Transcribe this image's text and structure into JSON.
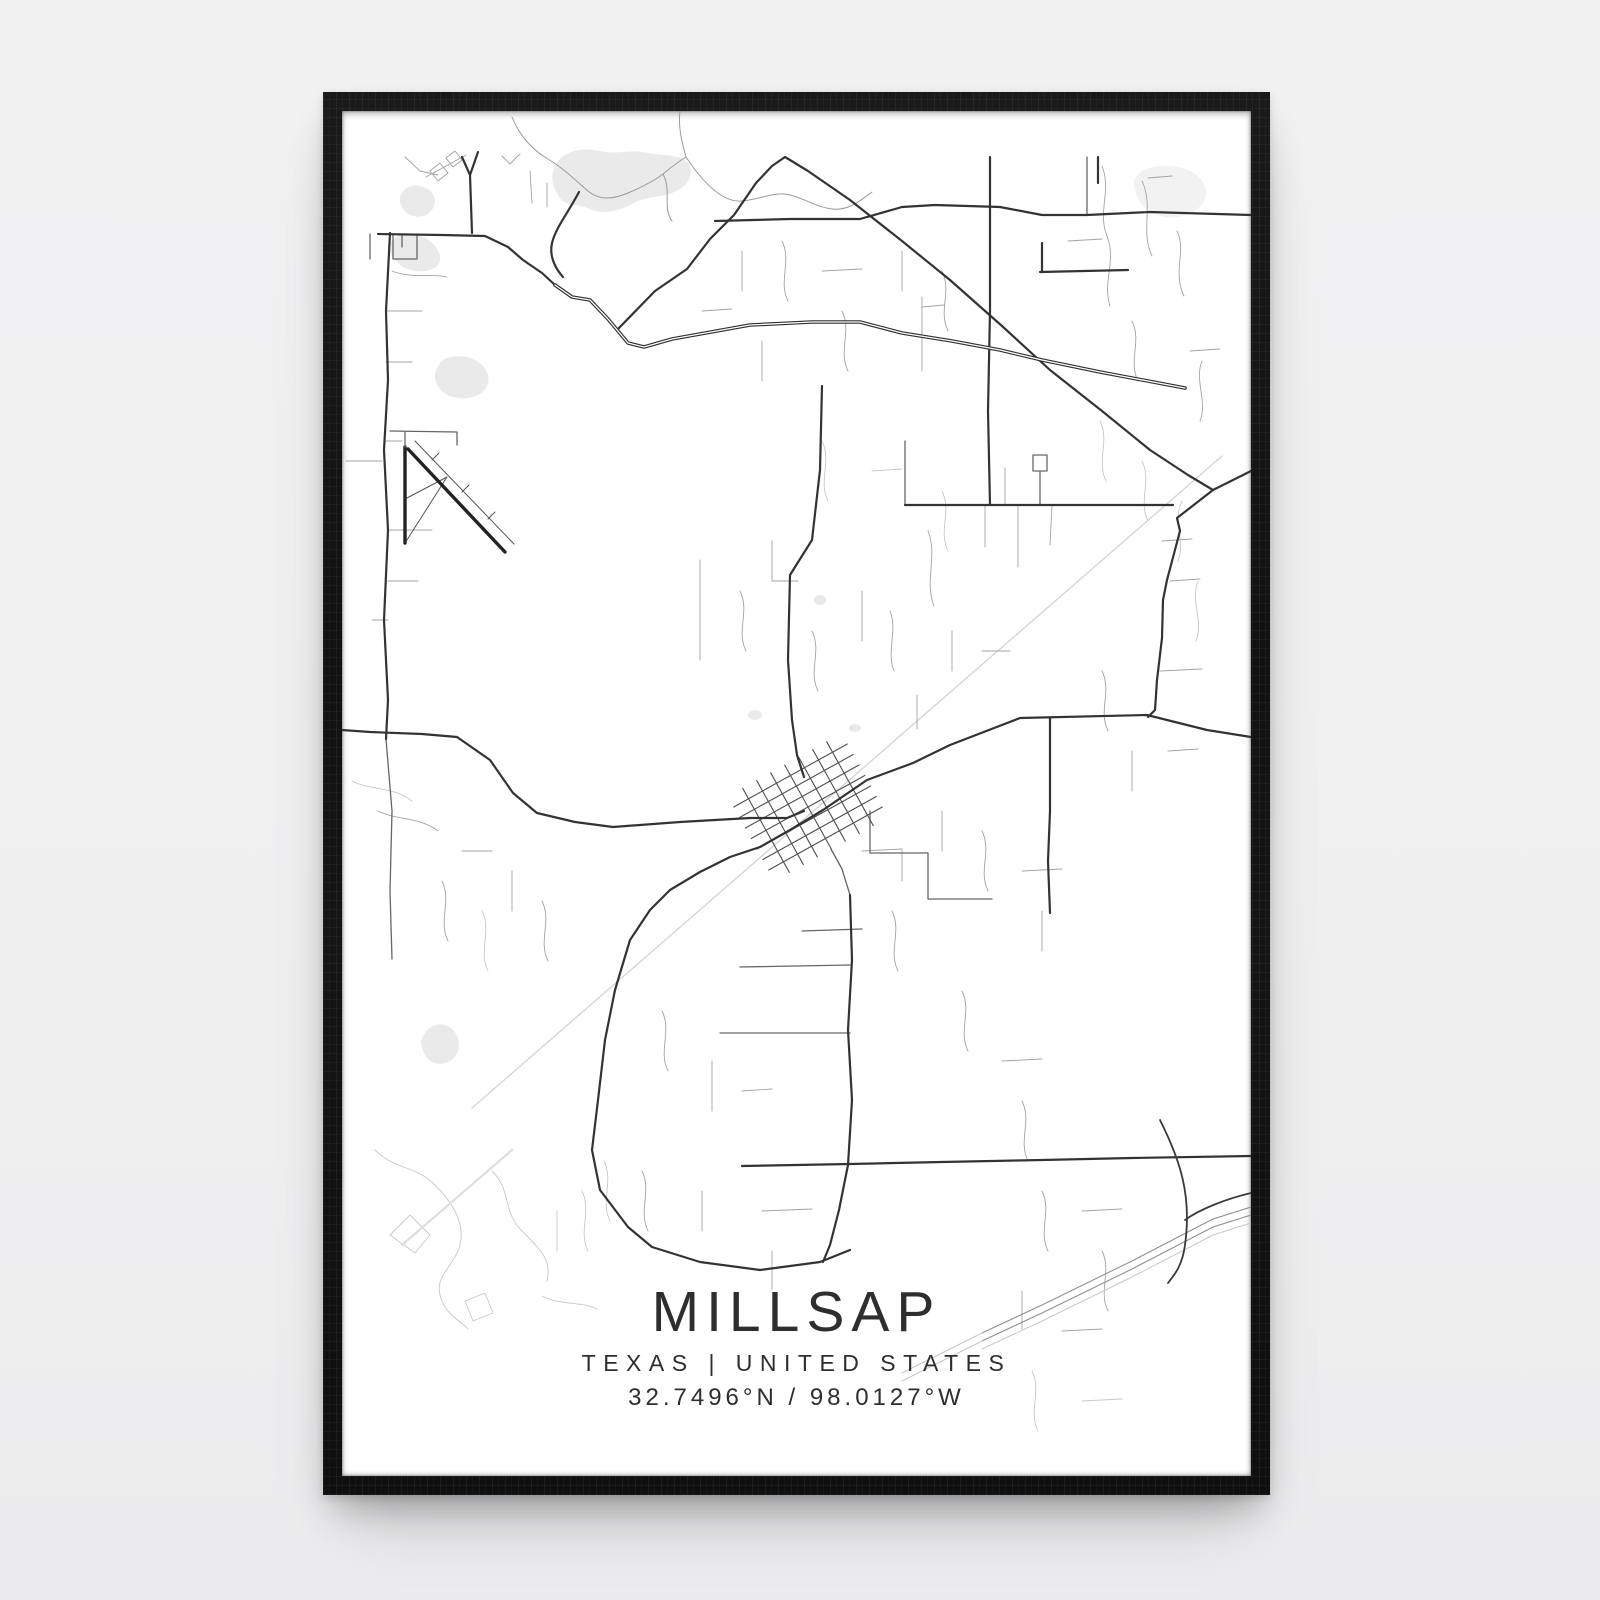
{
  "poster": {
    "title": "MILLSAP",
    "subtitle": "TEXAS | UNITED STATES",
    "coordinates": "32.7496°N / 98.0127°W"
  },
  "colors": {
    "page_background": "#f0f0f1",
    "frame": "#141414",
    "print": "#ffffff",
    "water": "#eaeaea",
    "text_primary": "#262626",
    "text_secondary": "#3a3a3a",
    "text_coords": "#474747"
  },
  "map": {
    "viewbox": "0 0 909 1365",
    "styles": {
      "major": {
        "c": "#333333",
        "w": 2.2
      },
      "major2": {
        "c": "#3a3a3a",
        "w": 1.8
      },
      "casing": {
        "c": "#2f2f2f",
        "w": 3.6
      },
      "core": {
        "c": "#ffffff",
        "w": 1.3
      },
      "medium": {
        "c": "#666666",
        "w": 1.3
      },
      "minor": {
        "c": "#a3a3a3",
        "w": 0.9
      },
      "river": {
        "c": "#9b9b9b",
        "w": 1.0
      },
      "faint": {
        "c": "#c8c8c8",
        "w": 0.9
      },
      "railband": {
        "c": "#dedede",
        "w": 2.2
      },
      "rail": {
        "c": "#d6d6d6",
        "w": 1.4
      },
      "grid": {
        "c": "#4f4f4f",
        "w": 1.1
      },
      "runway": {
        "c": "#222222",
        "w": 3.4
      },
      "apron": {
        "c": "#555555",
        "w": 1.0
      },
      "hwy": {
        "c": "#8f8f8f",
        "w": 1.1
      },
      "hwyfade": {
        "c": "#c9c9c9",
        "w": 1.0
      }
    },
    "water": [
      {
        "n": "lake-top-center",
        "d": "M213,55 C220,40 240,36 258,40 C276,44 288,38 306,42 C324,46 338,42 346,52 C352,60 348,72 338,78 C322,88 306,84 292,92 C278,100 262,104 248,98 C234,92 222,96 216,84 C210,74 208,66 213,55 Z"
      },
      {
        "n": "pond-left-upper",
        "d": "M63,78 C70,72 84,74 90,82 C96,90 92,100 84,104 C74,108 64,104 60,96 C56,88 58,84 63,78 Z"
      },
      {
        "n": "pond-left",
        "d": "M51,128 C60,120 78,122 88,130 C98,138 102,150 94,156 C84,163 64,161 56,152 C48,144 44,136 51,128 Z"
      },
      {
        "n": "pond-left-mid",
        "d": "M100,250 C110,242 130,244 140,254 C150,264 148,278 136,284 C124,290 106,288 98,278 C90,268 92,258 100,250 Z"
      },
      {
        "n": "pond-bottom-left",
        "d": "M83,922 C90,912 104,910 112,920 C120,930 118,944 108,950 C98,956 86,952 82,942 C78,932 78,930 83,922 Z"
      },
      {
        "n": "patch-top-right",
        "d": "M800,60 C820,50 850,55 860,70 C870,85 860,100 840,105 C820,110 800,100 795,85 C790,70 790,68 800,60 Z",
        "fill": "#f2f2f2"
      }
    ],
    "ponds": [
      {
        "cx": 413,
        "cy": 604,
        "rx": 7,
        "ry": 5
      },
      {
        "cx": 513,
        "cy": 617,
        "rx": 6,
        "ry": 4
      },
      {
        "cx": 478,
        "cy": 489,
        "rx": 6,
        "ry": 5
      }
    ],
    "roads": [
      {
        "s": "faint",
        "n": "tracks-bottom-left",
        "d": "M33,1039 C53,1059 73,1054 93,1074 C113,1094 123,1114 118,1134 C113,1154 93,1164 98,1184 C103,1204 118,1209 126,1218 M48,1124 L68,1104 L88,1124 L73,1142 Z M123,1190 L143,1182 L151,1202 L131,1210 Z M150,1060 C170,1080 160,1100 180,1120 C200,1140 210,1150 205,1170 M215,1100 L215,1140 M240,1080 C250,1100 236,1120 246,1140 M262,1050 C272,1070 258,1090 268,1110 M200,1185 C220,1195 240,1190 255,1198"
      },
      {
        "s": "railband",
        "n": "rail-spur-fading",
        "d": "M170,1039 L60,1134"
      },
      {
        "s": "faint",
        "n": "tracks-top-right",
        "d": "M758,310 C768,330 754,350 764,370 M800,350 C810,370 796,390 806,410 M840,390 C830,410 844,430 836,450 M856,470 C848,490 862,510 854,530"
      },
      {
        "s": "faint",
        "n": "tracks-middle",
        "d": "M480,330 C490,350 476,370 486,390 M530,360 L560,358 M600,380 C610,400 596,420 606,440 M10,670 C30,680 50,675 70,690 M140,800 C150,820 136,840 146,860 M690,1260 C700,1280 686,1300 696,1320 M740,1290 L780,1288"
      },
      {
        "s": "rail",
        "n": "railroad-diagonal",
        "d": "M880,345 L130,997"
      },
      {
        "s": "river",
        "n": "river-top",
        "d": "M338,0 C336,16 340,32 344,46 M170,6 C178,26 192,40 206,48 C224,59 234,70 246,80 C258,90 272,88 286,82 C300,76 312,70 321,63 C331,55 337,50 344,46 M344,46 C360,70 380,92 400,90 C420,88 432,80 448,84 C464,88 474,96 490,98 C506,100 518,90 530,81 M321,63 C330,80 320,96 330,110"
      },
      {
        "s": "minor",
        "n": "lanes-top-left",
        "d": "M63,46 L78,60 L96,64 M160,45 L168,53 L178,43 M188,60 L190,92 M205,72 L205,96 M84,66 L124,44"
      },
      {
        "s": "minor",
        "n": "buildings-top-left",
        "d": "M88,60 l10,-8 l8,10 l-10,8 Z M104,47 l9,-7 l7,9 l-9,7 Z"
      },
      {
        "s": "minor",
        "n": "lanes-top-center",
        "d": "M400,140 L400,180 M440,130 C450,150 436,170 446,190 M480,160 L520,158 M500,200 C510,220 496,240 506,260 M560,140 L560,180 M600,160 C610,180 596,200 606,220 M360,200 L390,198 M420,230 L420,270"
      },
      {
        "s": "minor",
        "n": "lanes-top-right",
        "d": "M760,55 C770,80 755,100 765,125 C775,150 760,170 768,195 M800,70 C812,95 798,120 810,145 M835,120 C845,140 830,160 842,185 M790,210 C800,230 786,250 796,270 M860,250 C852,270 866,290 858,310 M726,130 L760,128 M806,67 L830,65 M848,240 L878,238"
      },
      {
        "s": "minor",
        "n": "lanes-middle",
        "d": "M358,449 L358,549 M398,480 C408,500 394,520 404,540 M430,430 L430,470 L456,470 M470,520 C480,540 466,560 476,580 M520,480 L520,530 M548,500 C556,520 544,540 552,560 M586,420 C596,445 582,470 592,495 M610,520 L610,560 M640,540 L668,540 M575,584 L575,618"
      },
      {
        "s": "minor",
        "n": "lanes-left-mid",
        "d": "M50,160 C70,168 90,162 105,166 M46,419 L90,419 M46,470 L76,470 M30,509 L46,509 M4,350 L40,350 M44,330 L60,330 M44,200 L80,200 M44,251 L70,251"
      },
      {
        "s": "minor",
        "n": "lanes-left-bottom",
        "d": "M36,700 C56,710 76,705 96,720 M120,740 L150,740 M100,770 C110,790 96,810 106,830 M170,760 L170,800 M200,790 C210,810 196,830 206,850"
      },
      {
        "s": "minor",
        "n": "lanes-town-east",
        "d": "M520,740 L560,738 L560,770 M550,800 C560,820 546,840 556,860 M600,700 L600,740 M640,720 C650,740 636,760 646,780 M680,760 L720,758 M700,800 L700,840 M620,880 C630,900 616,920 626,940 M660,950 L700,948 M680,990 C690,1010 676,1030 686,1050"
      },
      {
        "s": "minor",
        "n": "lanes-bottom-center",
        "d": "M320,900 C330,920 316,940 326,960 M370,950 L370,1000 M400,980 L430,978 M360,1080 L360,1120 M300,1060 C310,1080 296,1100 306,1120 M420,1100 L470,1098 M430,1140 L430,1178"
      },
      {
        "s": "minor",
        "n": "lanes-bottom-right",
        "d": "M700,1080 C710,1100 696,1120 706,1140 M740,1100 L780,1098 M760,1140 C770,1160 756,1180 766,1200 M680,1180 L680,1218 M720,1220 L760,1218"
      },
      {
        "s": "minor",
        "n": "hangers-right-mid",
        "d": "M643,394 L643,436 M676,394 L676,456 M710,394 L708,434 M663,357 L663,394 M698,362 L698,394 M580,186 L580,260 M580,196 L602,194"
      },
      {
        "s": "minor",
        "n": "stubs-right-column",
        "d": "M820,430 L850,428 M828,470 L858,468 M818,560 L860,558 M826,640 L856,638 M760,560 C770,580 756,600 766,620 M790,640 L790,680"
      },
      {
        "s": "medium",
        "n": "rooms-left-edge",
        "d": "M28,123 L28,148 M51,124 L51,148 L75,148 L75,124 M60,124 L60,136"
      },
      {
        "s": "medium",
        "n": "stubs-near-south-road",
        "d": "M398,856 L508,854 M378,922 L508,922 M460,820 L520,818"
      },
      {
        "s": "medium",
        "n": "block-roads-southeast",
        "d": "M528,700 L528,742 L586,742 L586,788 L650,788"
      },
      {
        "s": "medium",
        "n": "hanger-up-right-mid",
        "d": "M563,394 L563,330"
      },
      {
        "s": "medium",
        "n": "loop-square-right",
        "d": "M691,344 L705,344 L705,360 L691,360 Z M698,360 L698,394"
      },
      {
        "s": "medium",
        "n": "vertical-top-right",
        "d": "M745,46 L745,104"
      },
      {
        "s": "medium",
        "n": "grid-exit-southeast",
        "d": "M489,738 L500,758 L508,784"
      },
      {
        "s": "medium",
        "n": "left-vertical-lower",
        "d": "M44,628 L50,700 L48,780 L50,848"
      },
      {
        "s": "grid",
        "n": "town-street-grid",
        "d": "M391.7,696 L505.3,633 M397.6,706.5 L511.2,643.5 M403.4,717 L517,654 M409.2,727.5 L522.8,664.5 M415,738 L528.6,675 M420.8,748.5 L534.4,685.5 M426.7,759 L540.3,696 M400.7,677.3 L447.3,761.3 M414.7,669.5 L461.3,753.5 M428.7,661.8 L475.3,745.8 M442.7,654 L489.3,738 M456.7,646.2 L503.3,730.2 M470.7,638.5 L517.3,722.5 M484.7,630.7 L531.3,714.7"
      },
      {
        "s": "major",
        "n": "road-top-fork",
        "d": "M120,46 L128,64 L130,122 M136,41 L128,64"
      },
      {
        "s": "major",
        "n": "highway-west-approach",
        "d": "M36,123 L100,124 L143,125 L166,136 L181,149 L200,162 L213,174"
      },
      {
        "s": "major",
        "n": "hook-road-top",
        "d": "M237,81 C226,102 214,116 210,132 C207,146 214,158 221,166"
      },
      {
        "s": "major",
        "n": "us180-through-town",
        "d": "M909,626 L865,619 L805,604 L678,607 L608,634 L571,652 L525,669 L481,699 L448,719 L418,736 L388,746 L358,761 L328,779 L308,799 L288,829 L273,879 L263,929 L256,989 L250,1039 L258,1079 L286,1116 L310,1136 L358,1151 L418,1159 L478,1151 L508,1139"
      },
      {
        "s": "major",
        "n": "county-road-west",
        "d": "M0,619 L28,621 L80,623 L115,626 L148,649 L171,682 L195,702 L233,711 L271,716 L338,711 L408,707 L445,707 L462,700"
      },
      {
        "s": "major",
        "n": "left-vertical-road",
        "d": "M48,122 L44,200 L46,269 L42,339 L46,419 L42,509 L46,589 L44,628"
      },
      {
        "s": "major",
        "n": "town-north-road",
        "d": "M480,275 L478,359 L470,429 L448,464 L446,549 L450,609 L455,644 L462,666"
      },
      {
        "s": "major",
        "n": "north-vertical-road",
        "d": "M648,46 L648,200 L646,300 L648,394"
      },
      {
        "s": "major",
        "n": "northeast-arc-road",
        "d": "M276,218 L313,180 L345,158 L368,128 L392,104 L414,72 L430,55 L443,46 L466,60 L508,89 L560,130 L608,169 L660,215 L708,259 L760,300 L808,339 L846,364 L871,379 L835,407 L838,420 L825,469 L821,489 L820,527 L815,569 L813,599 L806,606"
      },
      {
        "s": "major",
        "n": "east-west-road-north",
        "d": "M373,110 L448,108 L518,108 L560,96 L593,94 L658,96 L700,104 L745,104 L808,101 L909,104"
      },
      {
        "s": "major",
        "n": "east-west-road-mid",
        "d": "M563,394 L831,394"
      },
      {
        "s": "major",
        "n": "south-vertical-road",
        "d": "M508,784 L510,849 L506,919 L510,989 L506,1054 L497,1099 L488,1134 L481,1151"
      },
      {
        "s": "major",
        "n": "vertical-east-of-town",
        "d": "M708,607 L708,700 L706,750 L708,802"
      },
      {
        "s": "major",
        "n": "bottom-east-west-road",
        "d": "M400,1055 L508,1053 L600,1051 L700,1049 L790,1047 L909,1045"
      },
      {
        "s": "major",
        "n": "corner-roads-top-right",
        "d": "M698,161 L786,159 M700,161 L700,132 M756,46 L756,72 M871,379 L909,360"
      },
      {
        "s": "casing",
        "n": "highway-casing",
        "d": "M213,174 L230,186 L248,189 L266,208 L286,232 L302,236 L330,228 L408,214 L470,211 L518,211 L560,222 L610,230 L658,239 L700,249 L758,261 L843,277"
      },
      {
        "s": "core",
        "n": "highway-centerline",
        "d": "M213,174 L230,186 L248,189 L266,208 L286,232 L302,236 L330,228 L408,214 L470,211 L518,211 L560,222 L610,230 L658,239 L700,249 L758,261 L843,277"
      },
      {
        "s": "hwy",
        "n": "interstate-line-1",
        "d": "M909,1096 L871,1108 L790,1150 L700,1194 L640,1222"
      },
      {
        "s": "hwy",
        "n": "interstate-line-2",
        "d": "M909,1104 L871,1116 L790,1158 L700,1202 L640,1230"
      },
      {
        "s": "hwyfade",
        "n": "interstate-line-3",
        "d": "M909,1112 L871,1124 L790,1166 L700,1210 L640,1238 M640,1222 L560,1262 M640,1230 L560,1270"
      },
      {
        "s": "major2",
        "n": "curve-road-bottom-right",
        "d": "M818,1009 C838,1049 850,1084 843,1134 C840,1156 832,1164 826,1172 M909,1082 C884,1088 858,1098 843,1109"
      },
      {
        "s": "apron",
        "n": "airport-taxiway-outline",
        "d": "M73,330 L172,433 M90,349 L97,342 M120,381 L127,374 M146,408 L153,401 M63,432 L105,366 M63,388 L105,366"
      },
      {
        "s": "runway",
        "n": "airport-runway-north-south",
        "d": "M63,336 L63,432"
      },
      {
        "s": "runway",
        "n": "airport-runway-diagonal",
        "d": "M66,338 L163,441"
      },
      {
        "s": "medium",
        "n": "airport-access-road",
        "d": "M63,336 L63,321 M48,320 L115,321 L115,334"
      }
    ]
  }
}
